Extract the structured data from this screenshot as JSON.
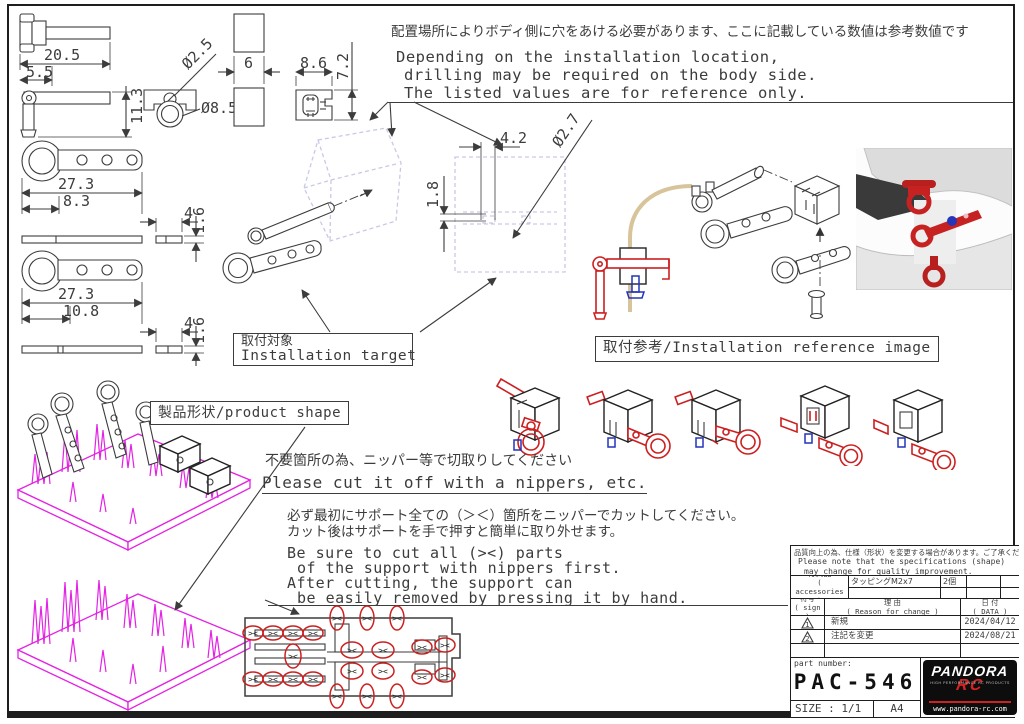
{
  "top_note": {
    "jp": "配置場所によりボディ側に穴をあける必要があります、ここに記載している数値は参考数値です",
    "en_lines": [
      "Depending on the installation location,",
      "drilling may be required on the body side.",
      "The listed values are for reference only."
    ]
  },
  "dimensions": {
    "pin_top_length": "20.5",
    "pin_top_offset": "5.5",
    "pin_side_height": "11.3",
    "shackle_hole_dia": "Ø2.5",
    "shackle_ring_dia": "Ø8.5",
    "block_width": "6",
    "bracket_width": "8.6",
    "bracket_height": "7.2",
    "plate_a_length": "27.3",
    "plate_a_offset": "8.3",
    "plate_a_end_width": "4",
    "plate_a_thickness": "1.6",
    "plate_b_length": "27.3",
    "plate_b_offset": "10.8",
    "plate_b_end_width": "4",
    "plate_b_thickness": "1.6",
    "body_hole_spacing": "4.2",
    "body_hole_height": "1.8",
    "body_hole_dia": "Ø2.7"
  },
  "labels": {
    "installation_target_jp": "取付対象",
    "installation_target_en": "Installation target",
    "installation_reference": "取付参考/Installation reference image",
    "product_shape": "製品形状/product shape"
  },
  "cutting": {
    "jp_title": "不要箇所の為、ニッパー等で切取りしてください",
    "en_title": "Please cut it off with a nippers, etc.",
    "jp_detail_1": "必ず最初にサポート全ての（＞＜）箇所をニッパーでカットしてください。",
    "jp_detail_2": "カット後はサポートを手で押すと簡単に取り外せます。",
    "en_detail_lines": [
      "Be sure to cut all (><) parts",
      "of the support with nippers first.",
      "After cutting, the support can",
      "be easily removed by pressing it by hand."
    ]
  },
  "sprue": {
    "mark": "><"
  },
  "title_block": {
    "note_jp": "品質向上の為、仕様（形状）を変更する場合があります。ご了承ください。",
    "note_en_1": "Please note that the specifications (shape)",
    "note_en_2": "may change for quality improvement.",
    "accessories_label_jp": "付属品",
    "accessories_label_en": "( accessories )",
    "accessory_name": "タッピングM2x7",
    "accessory_qty": "2個",
    "col_sign_jp": "符号",
    "col_sign_en": "( sign )",
    "col_reason_jp": "理 由",
    "col_reason_en": "( Reason for change )",
    "col_date_jp": "日 付",
    "col_date_en": "( DATA )",
    "revisions": [
      {
        "sign": "1",
        "reason": "新規",
        "date": "2024/04/12"
      },
      {
        "sign": "2",
        "reason": "注記を変更",
        "date": "2024/08/21"
      }
    ],
    "part_number_label": "part number:",
    "part_number": "PAC-546",
    "size_label": "SIZE : 1/1",
    "paper": "A4",
    "logo": {
      "brand": "PANDORA",
      "sub": "RC",
      "tagline": "HIGH PERFORMANCE RC PRODUCTS",
      "url": "www.pandora-rc.com"
    }
  },
  "colors": {
    "line": "#3c3c3c",
    "magenta": "#e322e3",
    "red": "#cc2020",
    "blue": "#2233bb",
    "tan": "#d8c49a",
    "ghost": "#c9c9e6"
  }
}
